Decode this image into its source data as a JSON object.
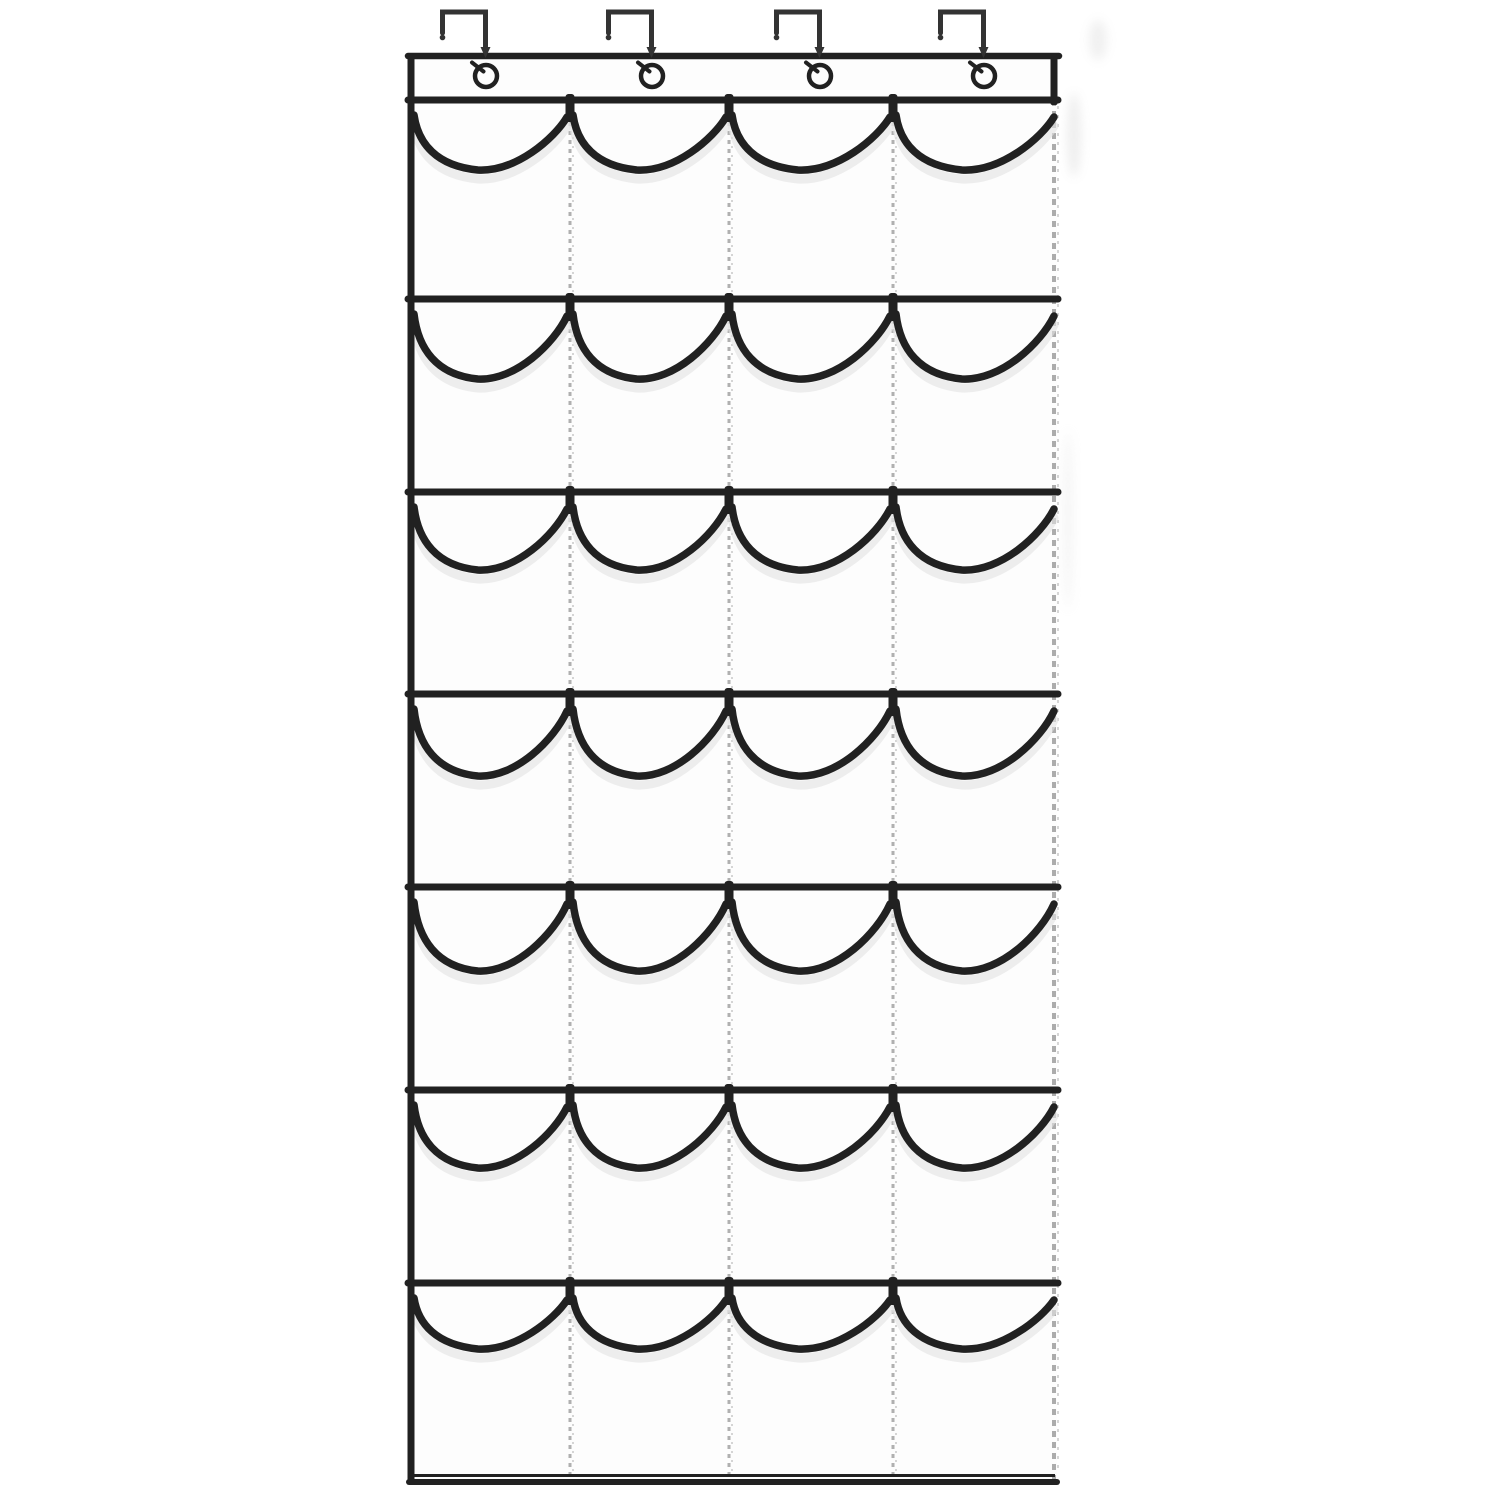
{
  "image": {
    "kind": "product-photo-line-art",
    "subject": "Over-the-door hanging shoe organizer with 28 clear pockets",
    "visible_text": [],
    "structure": {
      "hook_count": 4,
      "grommet_count": 4,
      "pocket_rows": 7,
      "pocket_columns": 4,
      "pocket_count": 28
    },
    "colors": {
      "background": "#ffffff",
      "outline": "#212121",
      "hook_metal": "#333333",
      "fabric": "#fdfdfd",
      "pocket_shadow": "#e3e3e3",
      "stitch_line": "#a8a8a8",
      "stitch_fuzz": "#cccccc",
      "smudge": "#cfcfcf"
    },
    "geometry": {
      "canvas_w": 1500,
      "canvas_h": 1500,
      "panel_left": 411,
      "panel_right": 1057,
      "band_top": 56,
      "band_bottom": 100,
      "panel_bottom": 1482,
      "row_bar_y": [
        100,
        299,
        492,
        694,
        887,
        1090,
        1283
      ],
      "divider_x": [
        570,
        729,
        893
      ],
      "grommet_x": [
        486,
        652,
        820,
        984
      ],
      "grommet_y": 76,
      "grommet_r": 11,
      "hook_top_y": 12,
      "hook_bar_reach": 46,
      "hook_left_leg_bottom": 33,
      "hook_right_leg_bottom": 49,
      "pocket_dip": [
        70,
        80,
        78,
        82,
        84,
        78,
        66
      ]
    }
  }
}
